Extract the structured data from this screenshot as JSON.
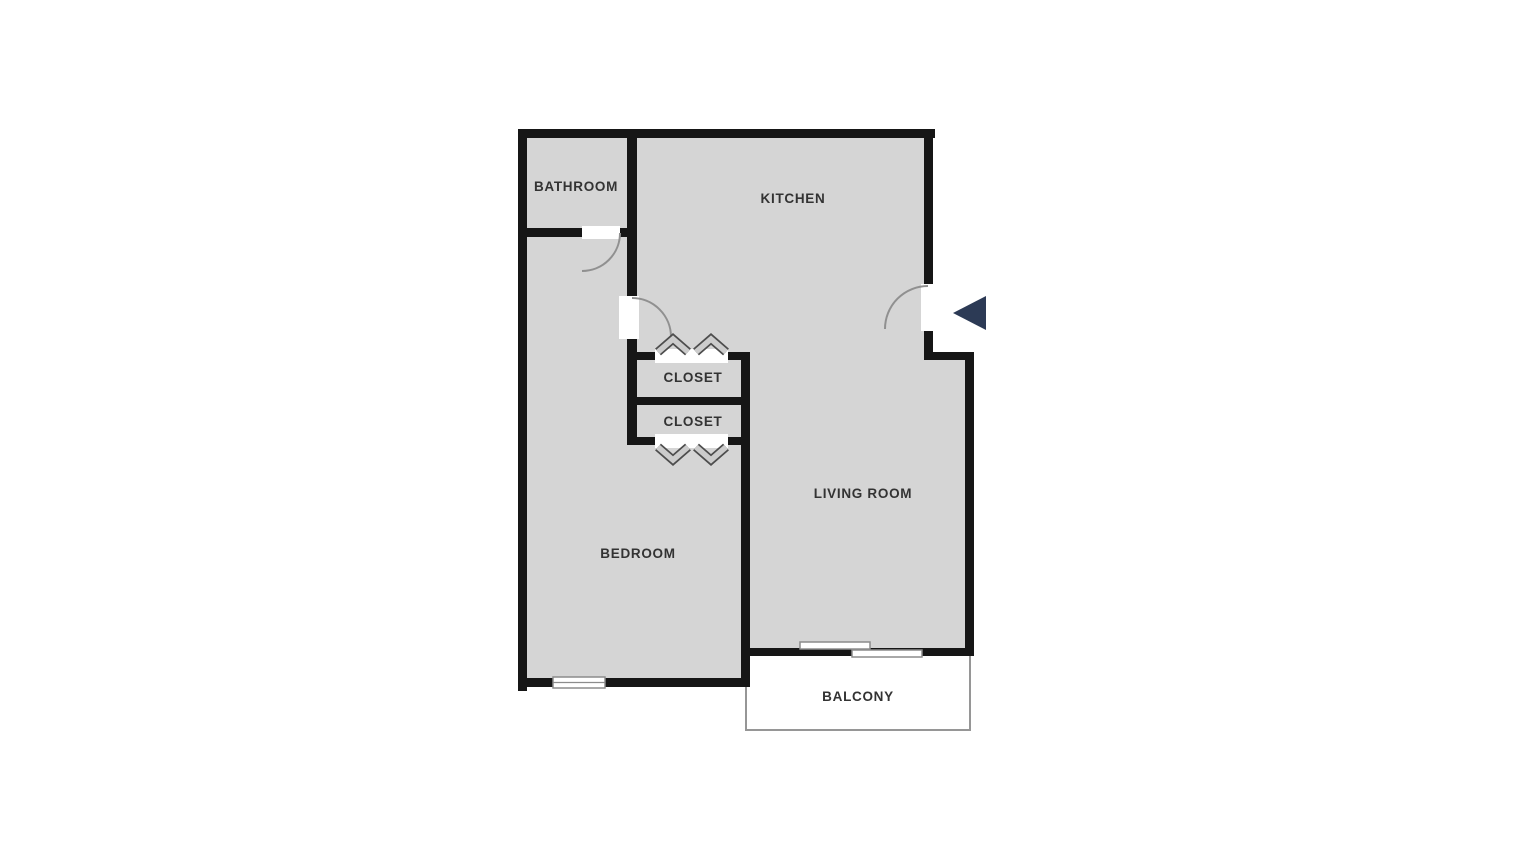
{
  "colors": {
    "background": "#ffffff",
    "floor": "#d5d5d5",
    "wall": "#161616",
    "door_leaf": "#ffffff",
    "arc": "#909090",
    "fixture_stroke": "#8c8c8c",
    "chevron_fill": "#cccccc",
    "chevron_stroke": "#4d4d4d",
    "balcony_fill": "#ffffff",
    "balcony_stroke": "#969696",
    "arrow": "#2c3a55",
    "label": "#333333"
  },
  "rooms": {
    "bathroom": {
      "label": "BATHROOM"
    },
    "kitchen": {
      "label": "KITCHEN"
    },
    "closet_top": {
      "label": "CLOSET"
    },
    "closet_bottom": {
      "label": "CLOSET"
    },
    "living_room": {
      "label": "LIVING ROOM"
    },
    "bedroom": {
      "label": "BEDROOM"
    },
    "balcony": {
      "label": "BALCONY"
    }
  }
}
